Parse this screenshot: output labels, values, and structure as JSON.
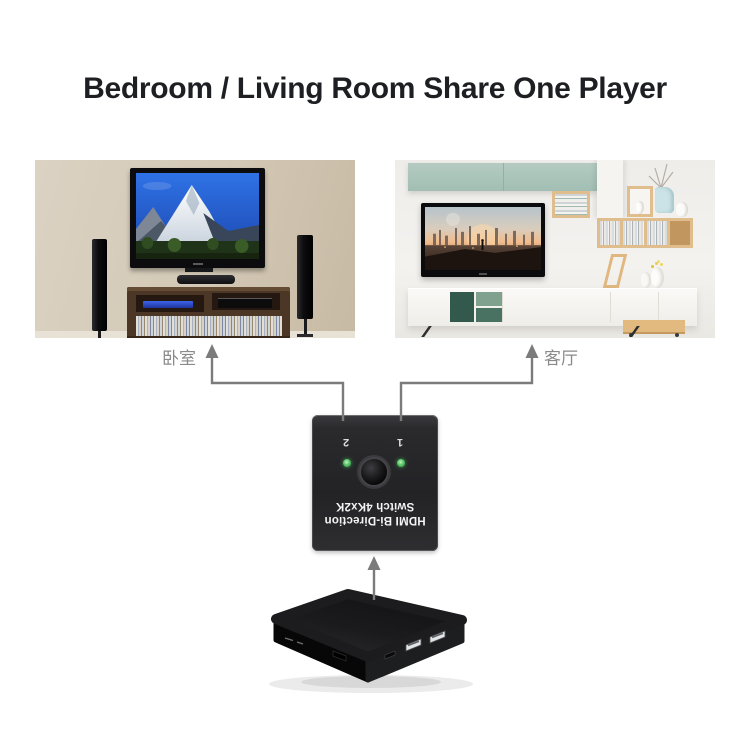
{
  "title": "Bedroom / Living Room Share One Player",
  "colors": {
    "background": "#ffffff",
    "title_text": "#1d1f23",
    "connector_gray": "#7b7b7b",
    "room_label_gray": "#8a8a8a",
    "switch_body": "#28282b",
    "led_green": "#46b65a"
  },
  "rooms": [
    {
      "name": "bedroom",
      "label": "卧室"
    },
    {
      "name": "living-room",
      "label": "客厅"
    }
  ],
  "switch_device": {
    "label_line1": "HDMI Bi-Direction",
    "label_line2": "Switch 4Kx2K",
    "orientation": "rotated-180",
    "ports": [
      {
        "number": "1"
      },
      {
        "number": "2"
      }
    ]
  }
}
